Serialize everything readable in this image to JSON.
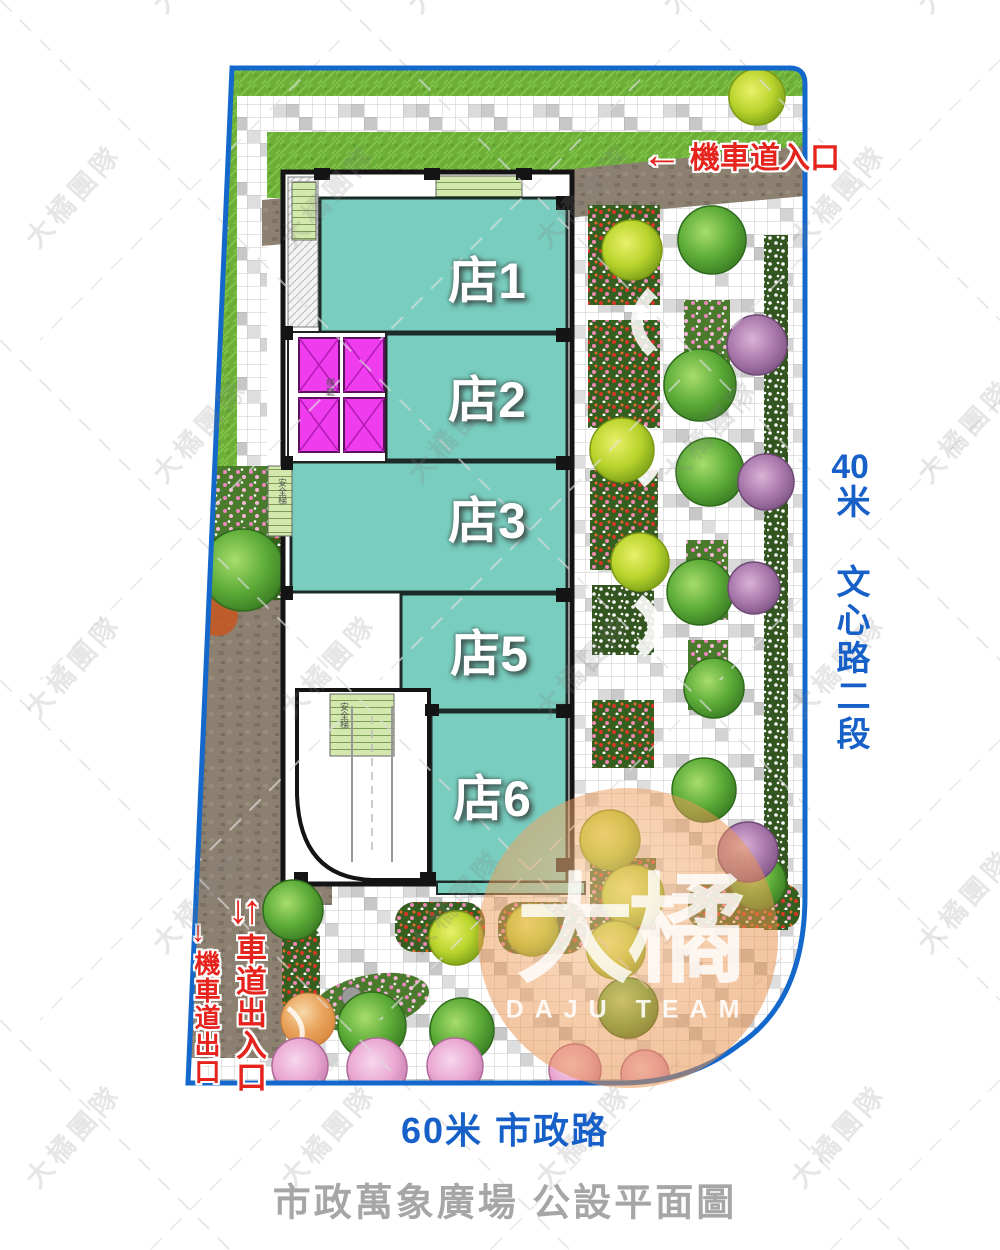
{
  "title": "市政萬象廣場 公設平面圖",
  "watermark": {
    "text": "大橘團隊"
  },
  "logo": {
    "zh": "大橘",
    "en": "DAJU TEAM"
  },
  "roads": {
    "right_num": "40",
    "right_name": "米 文心路二段",
    "bottom": "60米 市政路"
  },
  "annotations": {
    "moto_entry": {
      "arrow": "←",
      "label": "機車道入口"
    },
    "drive_gate": {
      "arrows": "↓↑",
      "label": "車道出入口"
    },
    "moto_exit": {
      "arrow": "↓",
      "label": "機車道出口"
    }
  },
  "building": {
    "stores": [
      {
        "label": "店1"
      },
      {
        "label": "店2"
      },
      {
        "label": "店3"
      },
      {
        "label": "店5"
      },
      {
        "label": "店6"
      }
    ],
    "elevator_lobby": "梯廳",
    "stair_label": "安全梯"
  },
  "colors": {
    "boundary_blue": "#1468cc",
    "store_teal": "#78cdbe",
    "elevator_magenta": "#ee3cee",
    "road_text_blue": "#1660c8",
    "annotation_red": "#e6231c",
    "title_gray": "#a6a6a6",
    "lawn_green": "#6cae38",
    "pavement_brown": "#8c8071"
  }
}
